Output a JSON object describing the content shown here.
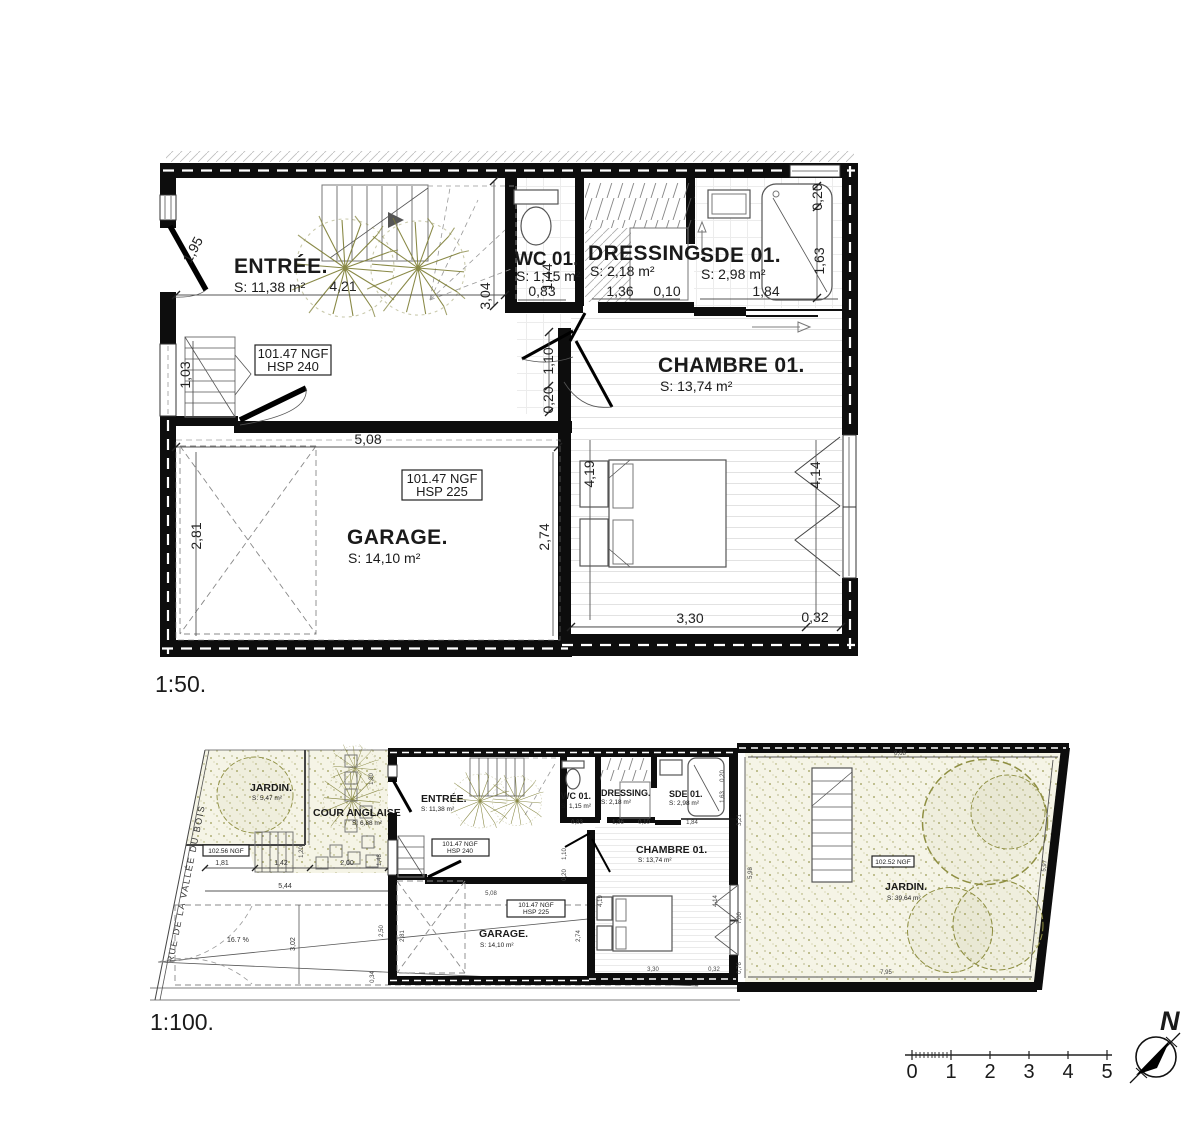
{
  "plan50": {
    "scale_label": "1:50.",
    "rooms": {
      "entree": {
        "name": "ENTRÉE.",
        "area": "S: 11,38 m²"
      },
      "wc": {
        "name": "WC 01.",
        "area": "S: 1,15 m²"
      },
      "dressing": {
        "name": "DRESSING.",
        "area": "S: 2,18 m²"
      },
      "sde": {
        "name": "SDE 01.",
        "area": "S: 2,98 m²"
      },
      "chambre": {
        "name": "CHAMBRE 01.",
        "area": "S: 13,74 m²"
      },
      "garage": {
        "name": "GARAGE.",
        "area": "S: 14,10 m²"
      }
    },
    "levels": {
      "entree_ngf": "101.47 NGF",
      "entree_hsp": "HSP 240",
      "garage_ngf": "101.47 NGF",
      "garage_hsp": "HSP 225"
    },
    "dims": {
      "entree_width": "4,21",
      "door": "1,95",
      "stair": "1,03",
      "hall_h": "3,04",
      "wc_w": "0,83",
      "wc_d": "1,44",
      "dr_w": "1,36",
      "joint": "0,10",
      "sde_w": "1,84",
      "sde_top": "0,20",
      "shower": "1,63",
      "hall1": "1,10",
      "hall2": "0,20",
      "gar_w": "5,08",
      "gar_l": "2,81",
      "gar_r": "2,74",
      "ch_l": "4,19",
      "ch_r": "4,14",
      "ch_w": "3,30",
      "ch_e": "0,32"
    }
  },
  "plan100": {
    "scale_label": "1:100.",
    "street": "RUE DE LA VALLÉE DU BOIS",
    "slope": "16.7 %",
    "jardin_front": {
      "name": "JARDIN.",
      "area": "S: 5,47 m²"
    },
    "cour": {
      "name": "COUR ANGLAISE",
      "area": "S: 6,88 m²"
    },
    "jardin_back": {
      "name": "JARDIN.",
      "area": "S: 39,64 m²"
    },
    "levels": {
      "front_ngf": "102.56 NGF",
      "back_ngf": "102.52 NGF"
    },
    "dims": {
      "a": "1,81",
      "b": "1,42",
      "c": "2,00",
      "total": "5,44",
      "depth": "3,02",
      "r1": "2,50",
      "r2": "0,34",
      "cour1": "1,20",
      "cour2": "1,48",
      "cour3": "1,80",
      "g_top": "8,68",
      "g_l1": "3,21",
      "g_l2": "5,98",
      "g_l3": "7,00",
      "g_l4": "0,76",
      "g_bottom": "7,95",
      "g_r": "5,97"
    }
  },
  "compass": {
    "north": "N"
  },
  "scalebar": {
    "ticks": [
      "0",
      "1",
      "2",
      "3",
      "4",
      "5"
    ]
  }
}
